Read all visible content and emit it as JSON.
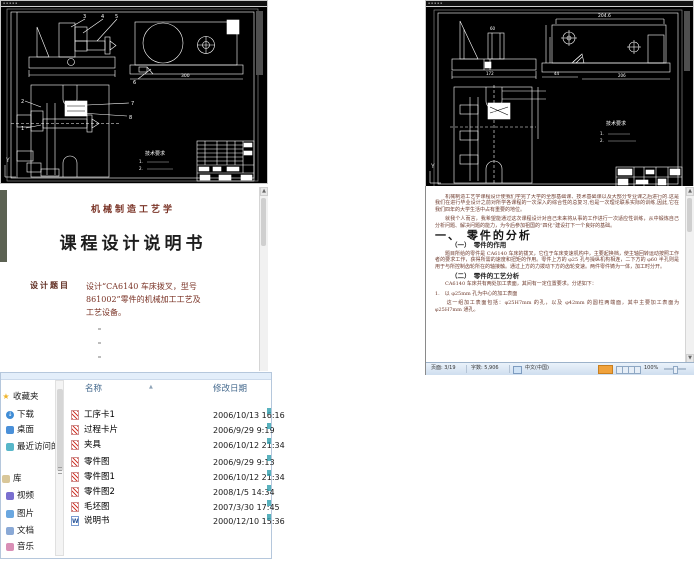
{
  "cad_left": {
    "tech_req_title": "技术要求",
    "tech_req_items": [
      "1.",
      "2."
    ],
    "balloons": [
      "3",
      "4",
      "5",
      "6",
      "2",
      "1",
      "7",
      "8"
    ],
    "dim_300": "300",
    "ucs": "Y"
  },
  "cad_right": {
    "tech_req_title": "技术要求",
    "tech_req_items": [
      "1.",
      "2."
    ],
    "dims": [
      "60",
      "204.6",
      "172",
      "44",
      "206"
    ],
    "ucs": "Y"
  },
  "doc_cover": {
    "course": "机械制造工艺学",
    "title": "课程设计说明书",
    "topic_label": "设计题目",
    "topic_line1": "设计“CA6140 车床拨叉，型号",
    "topic_line2": "861002”零件的机械加工工艺及",
    "topic_line3": "工艺设备。"
  },
  "doc_page": {
    "para1": "　　机械制造工艺学课程设计使我们学完了大学的全部基础课、技术基础课以及大部分专业课之后进行的.这是我们在进行毕业设计之前对所学各课程的一次深入的综合性的总复习,也是一次理论联系实际的训练,因此,它在我们四年的大学生活中占有重要的地位。",
    "para2": "　　就我个人而言，我希望能通过这次课程设计对自己未来将从事的工作进行一次适应性训练，从中锻炼自己分析问题、解决问题的能力，为今后参加祖国的“四化”建设打下一个良好的基础。",
    "h1": "一、 零件的分析",
    "h2a": "（一）　零件的作用",
    "para3": "　　题目所给的零件是 CA6140 车床的拨叉，它位于车床变速机构中，主要起换档，使主轴回转运动按照工作者的要求工作，获得所需的速度和扭矩的作用。零件上方的 φ25 孔与操纵机构相连，二下方的 φ60 半孔则是用于与所控制齿轮所在的轴接触。通过上方的力拨动下方的齿轮变速。两件零件铸为一体，加工时分开。",
    "h2b": "（二）　零件的工艺分析",
    "para4": "　　CA6140 车床共有两处加工表面，其间有一定位置要求。分述如下：",
    "list1": "1.　以 φ25mm 孔为中心的加工表面",
    "para5": "　　这一组加工表面包括：φ25H7mm 的孔，以及 φ42mm 的圆柱两端面，其中主要加工表面为 φ25H7mm 通孔。",
    "status": {
      "page": "页面: 3/19",
      "words": "字数: 5,906",
      "lang": "中文(中国)",
      "zoom": "100%"
    }
  },
  "explorer": {
    "columns": [
      "名称",
      "修改日期"
    ],
    "sidebar": [
      {
        "label": "收藏夹"
      },
      {
        "label": "下载"
      },
      {
        "label": "桌面"
      },
      {
        "label": "最近访问的位置"
      },
      {
        "label": "库"
      },
      {
        "label": "视频"
      },
      {
        "label": "图片"
      },
      {
        "label": "文档"
      },
      {
        "label": "音乐"
      }
    ],
    "files": [
      {
        "name": "工序卡1",
        "date": "2006/10/13 16:16"
      },
      {
        "name": "过程卡片",
        "date": "2006/9/29 9:19"
      },
      {
        "name": "夹具",
        "date": "2006/10/12 21:34"
      },
      {
        "name": "零件图",
        "date": "2006/9/29 9:13"
      },
      {
        "name": "零件图1",
        "date": "2006/10/12 21:34"
      },
      {
        "name": "零件图2",
        "date": "2008/1/5 14:34"
      },
      {
        "name": "毛坯图",
        "date": "2007/3/30 17:45"
      },
      {
        "name": "说明书",
        "date": "2000/12/10 15:36"
      }
    ],
    "word_icon_letter": "W"
  }
}
